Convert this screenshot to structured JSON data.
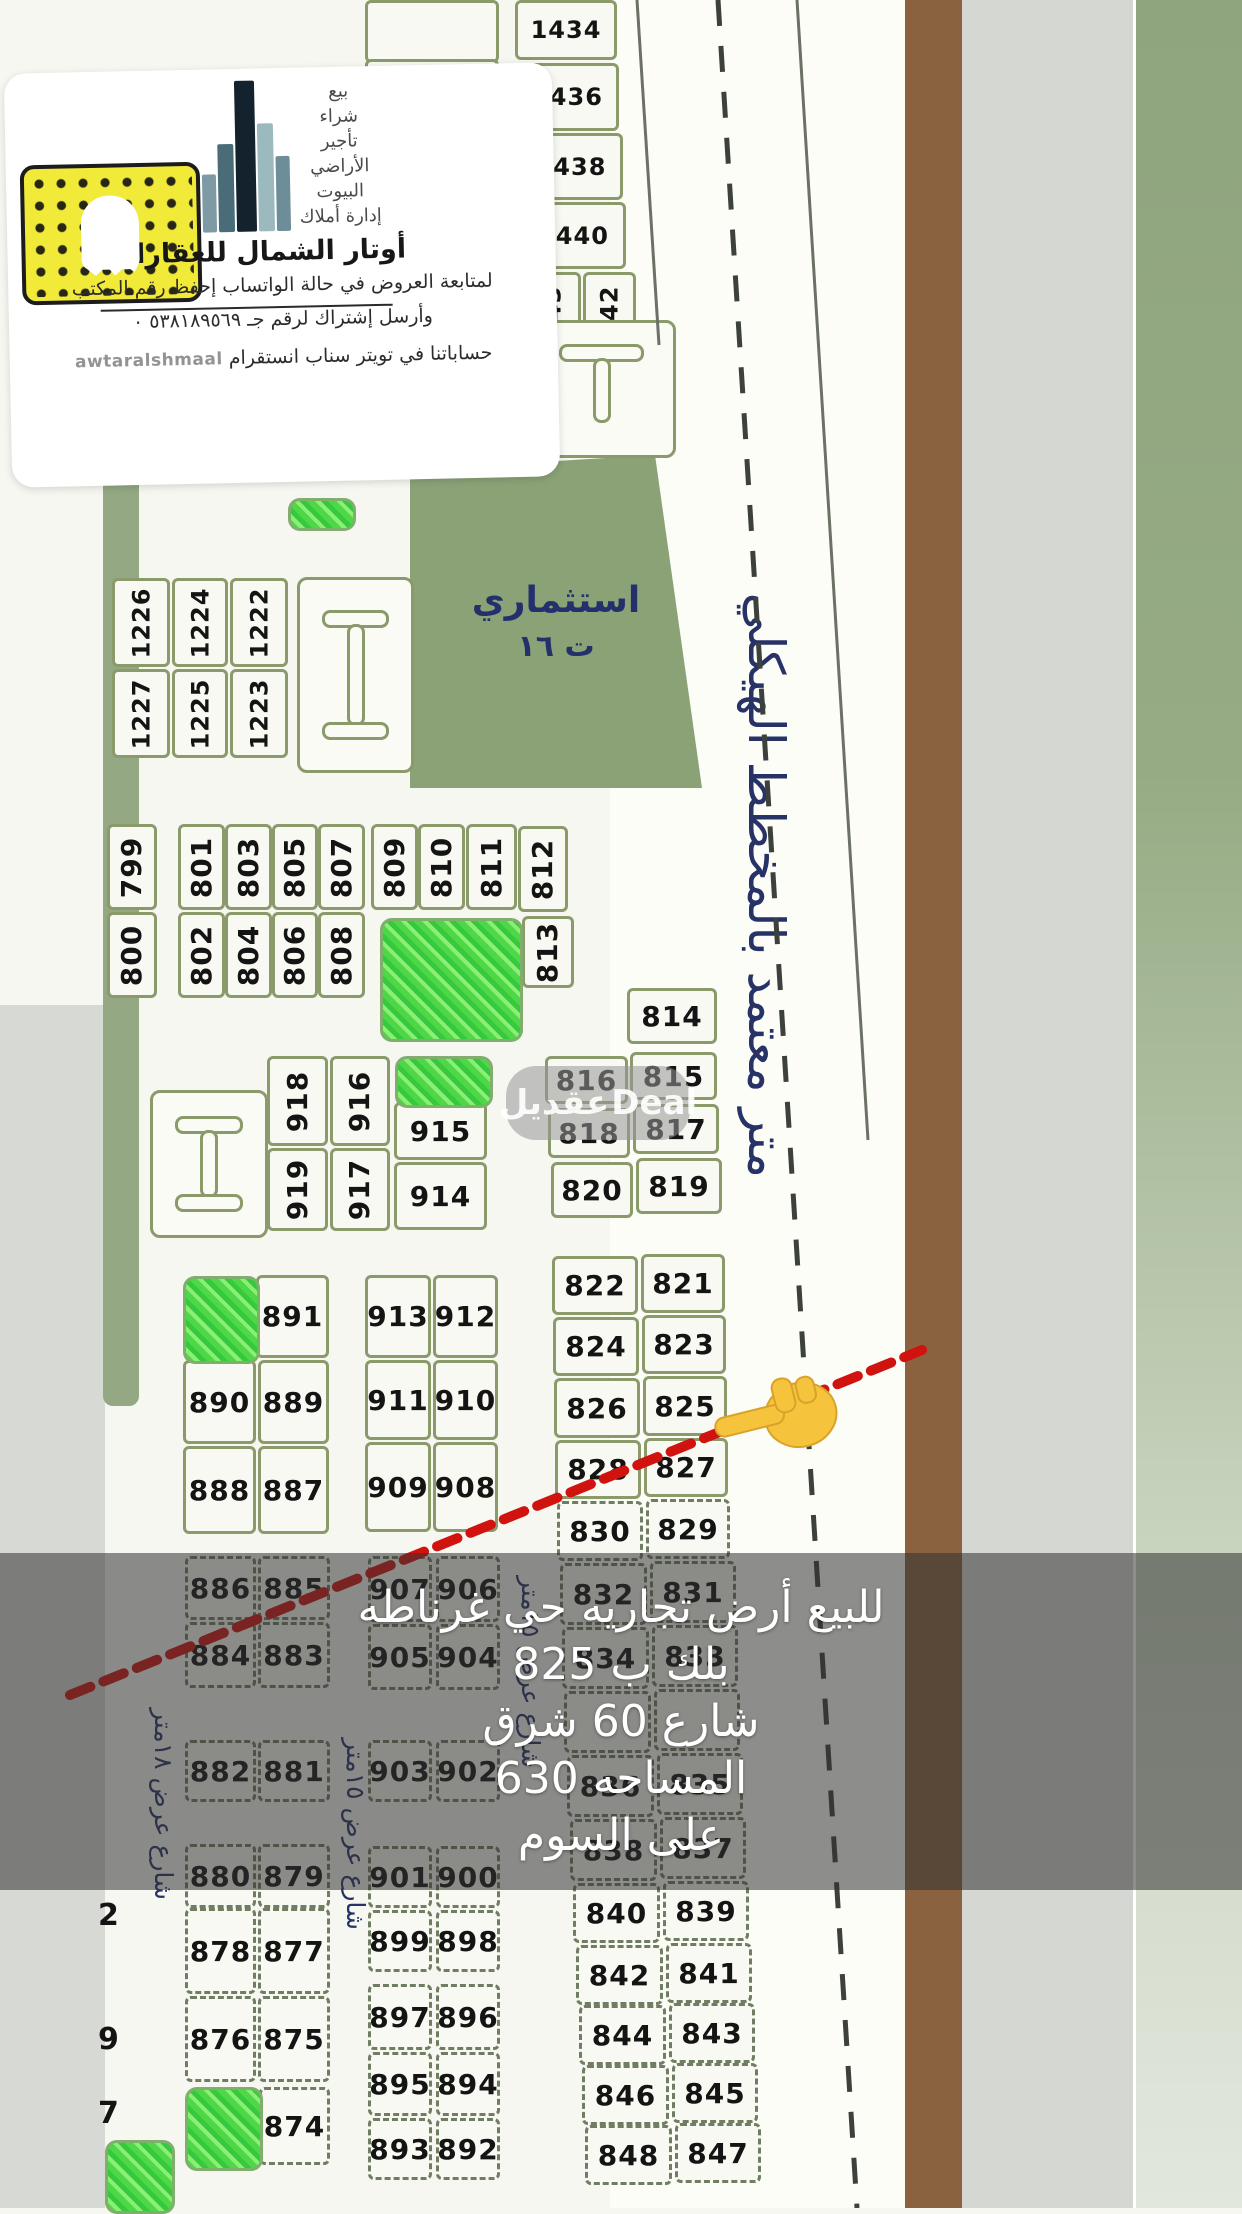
{
  "logo_card": {
    "services": [
      "بيع",
      "شراء",
      "تأجير",
      "الأراضي",
      "البيوت",
      "إدارة أملاك"
    ],
    "company_name": "أوتار الشمال للعقارات",
    "line1": "لمتابعة العروض في حالة الواتساب إحفظ رقم المكتب",
    "line2": "وأرسل إشتراك لرقم جـ ٥٣٨١٨٩٥٦٩ ٠",
    "line3": "حساباتنا في تويتر سناب انستقرام",
    "handle": "awtaralshmaal"
  },
  "overlay": {
    "lines": [
      "للبيع أرض  تجاريه حي غرناطه",
      "بلك ب 825",
      "شارع 60 شرق",
      "المساحه 630",
      "على السوم"
    ]
  },
  "map": {
    "road_label": "متر معتمد بالمخطط الهيكلي",
    "investment_label": "استثماري",
    "investment_sub": "ت ١٦",
    "watermark_ar": "عقديل",
    "watermark_en": "Deal",
    "colors": {
      "snap_yellow": "#f2ea39",
      "red_line": "#d11310",
      "brown_strip": "#8a6240",
      "sage": "#93a883",
      "park_green": "#4ed847"
    },
    "street_labels": [
      {
        "t": "شارع عرض ١٨متر",
        "x": 178,
        "y": 1600,
        "w": 300
      },
      {
        "t": "شارع عرض ١٥متر",
        "x": 370,
        "y": 1600,
        "w": 330
      },
      {
        "t": "شارع عرض ١٥متر",
        "x": 545,
        "y": 1478,
        "w": 290
      }
    ],
    "partial_digits": [
      {
        "t": "2",
        "x": 98,
        "y": 1898
      },
      {
        "t": "9",
        "x": 98,
        "y": 2022
      },
      {
        "t": "7",
        "x": 98,
        "y": 2096
      }
    ],
    "parks": [
      {
        "x": 288,
        "y": 498,
        "w": 62,
        "h": 27
      },
      {
        "x": 380,
        "y": 918,
        "w": 137,
        "h": 118
      },
      {
        "x": 395,
        "y": 1056,
        "w": 92,
        "h": 46
      },
      {
        "x": 183,
        "y": 1276,
        "w": 71,
        "h": 82
      },
      {
        "x": 185,
        "y": 2087,
        "w": 72,
        "h": 78
      },
      {
        "x": 105,
        "y": 2140,
        "w": 64,
        "h": 68
      }
    ],
    "iblocks": [
      {
        "type": "i",
        "x": 297,
        "y": 577,
        "w": 111,
        "h": 190
      },
      {
        "type": "i",
        "x": 150,
        "y": 1090,
        "w": 112,
        "h": 142
      },
      {
        "type": "t",
        "x": 527,
        "y": 320,
        "w": 143,
        "h": 132
      }
    ],
    "plots": [
      {
        "n": "1434",
        "x": 515,
        "y": 0,
        "w": 102,
        "h": 60,
        "s": 1
      },
      {
        "n": "1436",
        "x": 516,
        "y": 63,
        "w": 103,
        "h": 68,
        "s": 1
      },
      {
        "n": "1438",
        "x": 519,
        "y": 133,
        "w": 104,
        "h": 67,
        "s": 1
      },
      {
        "n": "1440",
        "x": 521,
        "y": 202,
        "w": 105,
        "h": 67,
        "s": 1
      },
      {
        "n": "1443",
        "x": 524,
        "y": 272,
        "w": 57,
        "h": 97,
        "r": 1,
        "s": 1
      },
      {
        "n": "1442",
        "x": 583,
        "y": 272,
        "w": 53,
        "h": 97,
        "r": 1,
        "s": 1
      },
      {
        "n": "1226",
        "x": 112,
        "y": 578,
        "w": 58,
        "h": 89,
        "r": 1,
        "s": 1
      },
      {
        "n": "1227",
        "x": 112,
        "y": 669,
        "w": 58,
        "h": 89,
        "r": 1,
        "s": 1
      },
      {
        "n": "1224",
        "x": 172,
        "y": 578,
        "w": 56,
        "h": 89,
        "r": 1,
        "s": 1
      },
      {
        "n": "1225",
        "x": 172,
        "y": 669,
        "w": 56,
        "h": 89,
        "r": 1,
        "s": 1
      },
      {
        "n": "1222",
        "x": 230,
        "y": 578,
        "w": 58,
        "h": 89,
        "r": 1,
        "s": 1
      },
      {
        "n": "1223",
        "x": 230,
        "y": 669,
        "w": 58,
        "h": 89,
        "r": 1,
        "s": 1
      },
      {
        "n": "799",
        "x": 107,
        "y": 824,
        "w": 50,
        "h": 86,
        "r": 1
      },
      {
        "n": "800",
        "x": 107,
        "y": 912,
        "w": 50,
        "h": 86,
        "r": 1
      },
      {
        "n": "801",
        "x": 178,
        "y": 824,
        "w": 47,
        "h": 86,
        "r": 1
      },
      {
        "n": "802",
        "x": 178,
        "y": 912,
        "w": 47,
        "h": 86,
        "r": 1
      },
      {
        "n": "803",
        "x": 225,
        "y": 824,
        "w": 47,
        "h": 86,
        "r": 1
      },
      {
        "n": "804",
        "x": 225,
        "y": 912,
        "w": 47,
        "h": 86,
        "r": 1
      },
      {
        "n": "805",
        "x": 272,
        "y": 824,
        "w": 46,
        "h": 86,
        "r": 1
      },
      {
        "n": "806",
        "x": 272,
        "y": 912,
        "w": 46,
        "h": 86,
        "r": 1
      },
      {
        "n": "807",
        "x": 318,
        "y": 824,
        "w": 47,
        "h": 86,
        "r": 1
      },
      {
        "n": "808",
        "x": 318,
        "y": 912,
        "w": 47,
        "h": 86,
        "r": 1
      },
      {
        "n": "809",
        "x": 371,
        "y": 824,
        "w": 47,
        "h": 86,
        "r": 1
      },
      {
        "n": "810",
        "x": 418,
        "y": 824,
        "w": 47,
        "h": 86,
        "r": 1
      },
      {
        "n": "811",
        "x": 466,
        "y": 824,
        "w": 51,
        "h": 86,
        "r": 1
      },
      {
        "n": "812",
        "x": 518,
        "y": 826,
        "w": 50,
        "h": 86,
        "r": 1
      },
      {
        "n": "813",
        "x": 522,
        "y": 916,
        "w": 52,
        "h": 72,
        "r": 1
      },
      {
        "n": "814",
        "x": 627,
        "y": 988,
        "w": 90,
        "h": 56
      },
      {
        "n": "816",
        "x": 545,
        "y": 1056,
        "w": 83,
        "h": 48
      },
      {
        "n": "815",
        "x": 630,
        "y": 1052,
        "w": 87,
        "h": 48
      },
      {
        "n": "818",
        "x": 548,
        "y": 1108,
        "w": 82,
        "h": 50
      },
      {
        "n": "817",
        "x": 633,
        "y": 1104,
        "w": 86,
        "h": 50
      },
      {
        "n": "820",
        "x": 551,
        "y": 1162,
        "w": 82,
        "h": 56
      },
      {
        "n": "819",
        "x": 636,
        "y": 1158,
        "w": 86,
        "h": 56
      },
      {
        "n": "822",
        "x": 552,
        "y": 1256,
        "w": 86,
        "h": 59
      },
      {
        "n": "821",
        "x": 641,
        "y": 1254,
        "w": 84,
        "h": 59
      },
      {
        "n": "824",
        "x": 553,
        "y": 1317,
        "w": 86,
        "h": 59
      },
      {
        "n": "823",
        "x": 642,
        "y": 1315,
        "w": 84,
        "h": 59
      },
      {
        "n": "826",
        "x": 554,
        "y": 1378,
        "w": 86,
        "h": 60
      },
      {
        "n": "825",
        "x": 643,
        "y": 1376,
        "w": 84,
        "h": 60
      },
      {
        "n": "828",
        "x": 555,
        "y": 1440,
        "w": 86,
        "h": 59
      },
      {
        "n": "827",
        "x": 644,
        "y": 1438,
        "w": 84,
        "h": 59
      },
      {
        "n": "830",
        "x": 557,
        "y": 1501,
        "w": 86,
        "h": 60,
        "d": 1
      },
      {
        "n": "829",
        "x": 646,
        "y": 1499,
        "w": 84,
        "h": 60,
        "d": 1
      },
      {
        "n": "832",
        "x": 560,
        "y": 1563,
        "w": 87,
        "h": 62,
        "d": 1
      },
      {
        "n": "831",
        "x": 650,
        "y": 1561,
        "w": 86,
        "h": 62,
        "d": 1
      },
      {
        "n": "834",
        "x": 562,
        "y": 1627,
        "w": 87,
        "h": 62,
        "d": 1
      },
      {
        "n": "833",
        "x": 652,
        "y": 1625,
        "w": 86,
        "h": 62,
        "d": 1
      },
      {
        "n": null,
        "x": 564,
        "y": 1691,
        "w": 87,
        "h": 62,
        "d": 1
      },
      {
        "n": null,
        "x": 654,
        "y": 1689,
        "w": 86,
        "h": 62,
        "d": 1
      },
      {
        "n": "836",
        "x": 567,
        "y": 1755,
        "w": 87,
        "h": 62,
        "d": 1
      },
      {
        "n": "835",
        "x": 657,
        "y": 1753,
        "w": 86,
        "h": 62,
        "d": 1
      },
      {
        "n": "838",
        "x": 570,
        "y": 1819,
        "w": 87,
        "h": 62,
        "d": 1
      },
      {
        "n": "837",
        "x": 660,
        "y": 1817,
        "w": 86,
        "h": 62,
        "d": 1
      },
      {
        "n": "840",
        "x": 573,
        "y": 1883,
        "w": 87,
        "h": 60,
        "d": 1
      },
      {
        "n": "839",
        "x": 663,
        "y": 1881,
        "w": 86,
        "h": 60,
        "d": 1
      },
      {
        "n": "842",
        "x": 576,
        "y": 1945,
        "w": 87,
        "h": 60,
        "d": 1
      },
      {
        "n": "841",
        "x": 666,
        "y": 1943,
        "w": 86,
        "h": 60,
        "d": 1
      },
      {
        "n": "844",
        "x": 579,
        "y": 2005,
        "w": 87,
        "h": 60,
        "d": 1
      },
      {
        "n": "843",
        "x": 669,
        "y": 2003,
        "w": 86,
        "h": 60,
        "d": 1
      },
      {
        "n": "846",
        "x": 582,
        "y": 2065,
        "w": 87,
        "h": 60,
        "d": 1
      },
      {
        "n": "845",
        "x": 672,
        "y": 2063,
        "w": 86,
        "h": 60,
        "d": 1
      },
      {
        "n": "848",
        "x": 585,
        "y": 2125,
        "w": 87,
        "h": 60,
        "d": 1
      },
      {
        "n": "847",
        "x": 675,
        "y": 2123,
        "w": 86,
        "h": 60,
        "d": 1
      },
      {
        "n": "918",
        "x": 267,
        "y": 1056,
        "w": 61,
        "h": 90,
        "r": 1
      },
      {
        "n": "916",
        "x": 330,
        "y": 1056,
        "w": 60,
        "h": 90,
        "r": 1
      },
      {
        "n": "919",
        "x": 267,
        "y": 1148,
        "w": 61,
        "h": 83,
        "r": 1
      },
      {
        "n": "917",
        "x": 330,
        "y": 1148,
        "w": 60,
        "h": 83,
        "r": 1
      },
      {
        "n": "915",
        "x": 394,
        "y": 1102,
        "w": 93,
        "h": 58
      },
      {
        "n": "914",
        "x": 394,
        "y": 1162,
        "w": 93,
        "h": 68
      },
      {
        "n": "891",
        "x": 256,
        "y": 1275,
        "w": 73,
        "h": 83
      },
      {
        "n": "890",
        "x": 183,
        "y": 1360,
        "w": 73,
        "h": 84
      },
      {
        "n": "889",
        "x": 258,
        "y": 1360,
        "w": 71,
        "h": 84
      },
      {
        "n": "888",
        "x": 183,
        "y": 1446,
        "w": 73,
        "h": 88
      },
      {
        "n": "887",
        "x": 258,
        "y": 1446,
        "w": 71,
        "h": 88
      },
      {
        "n": "913",
        "x": 365,
        "y": 1275,
        "w": 66,
        "h": 83
      },
      {
        "n": "912",
        "x": 433,
        "y": 1275,
        "w": 65,
        "h": 83
      },
      {
        "n": "911",
        "x": 365,
        "y": 1360,
        "w": 66,
        "h": 80
      },
      {
        "n": "910",
        "x": 433,
        "y": 1360,
        "w": 65,
        "h": 80
      },
      {
        "n": "909",
        "x": 365,
        "y": 1442,
        "w": 66,
        "h": 90
      },
      {
        "n": "908",
        "x": 433,
        "y": 1442,
        "w": 65,
        "h": 90
      },
      {
        "n": "886",
        "x": 185,
        "y": 1556,
        "w": 71,
        "h": 64,
        "d": 1
      },
      {
        "n": "885",
        "x": 258,
        "y": 1556,
        "w": 72,
        "h": 64,
        "d": 1
      },
      {
        "n": "884",
        "x": 185,
        "y": 1622,
        "w": 71,
        "h": 66,
        "d": 1
      },
      {
        "n": "883",
        "x": 258,
        "y": 1622,
        "w": 72,
        "h": 66,
        "d": 1
      },
      {
        "n": "882",
        "x": 185,
        "y": 1740,
        "w": 71,
        "h": 62,
        "d": 1
      },
      {
        "n": "881",
        "x": 258,
        "y": 1740,
        "w": 72,
        "h": 62,
        "d": 1
      },
      {
        "n": "880",
        "x": 185,
        "y": 1844,
        "w": 71,
        "h": 64,
        "d": 1
      },
      {
        "n": "879",
        "x": 258,
        "y": 1844,
        "w": 72,
        "h": 64,
        "d": 1
      },
      {
        "n": "878",
        "x": 185,
        "y": 1908,
        "w": 71,
        "h": 86,
        "d": 1
      },
      {
        "n": "877",
        "x": 258,
        "y": 1908,
        "w": 72,
        "h": 86,
        "d": 1
      },
      {
        "n": "876",
        "x": 185,
        "y": 1996,
        "w": 71,
        "h": 86,
        "d": 1
      },
      {
        "n": "875",
        "x": 258,
        "y": 1996,
        "w": 72,
        "h": 86,
        "d": 1
      },
      {
        "n": "874",
        "x": 259,
        "y": 2087,
        "w": 71,
        "h": 78,
        "d": 1
      },
      {
        "n": "907",
        "x": 368,
        "y": 1556,
        "w": 64,
        "h": 66,
        "d": 1
      },
      {
        "n": "906",
        "x": 436,
        "y": 1556,
        "w": 64,
        "h": 66,
        "d": 1
      },
      {
        "n": "905",
        "x": 368,
        "y": 1624,
        "w": 64,
        "h": 66,
        "d": 1
      },
      {
        "n": "904",
        "x": 436,
        "y": 1624,
        "w": 64,
        "h": 66,
        "d": 1
      },
      {
        "n": "903",
        "x": 368,
        "y": 1740,
        "w": 64,
        "h": 62,
        "d": 1
      },
      {
        "n": "902",
        "x": 436,
        "y": 1740,
        "w": 64,
        "h": 62,
        "d": 1
      },
      {
        "n": "901",
        "x": 368,
        "y": 1846,
        "w": 64,
        "h": 62,
        "d": 1
      },
      {
        "n": "900",
        "x": 436,
        "y": 1846,
        "w": 64,
        "h": 62,
        "d": 1
      },
      {
        "n": "899",
        "x": 368,
        "y": 1910,
        "w": 64,
        "h": 62,
        "d": 1
      },
      {
        "n": "898",
        "x": 436,
        "y": 1910,
        "w": 64,
        "h": 62,
        "d": 1
      },
      {
        "n": "897",
        "x": 368,
        "y": 1984,
        "w": 64,
        "h": 66,
        "d": 1
      },
      {
        "n": "896",
        "x": 436,
        "y": 1984,
        "w": 64,
        "h": 66,
        "d": 1
      },
      {
        "n": "895",
        "x": 368,
        "y": 2052,
        "w": 64,
        "h": 64,
        "d": 1
      },
      {
        "n": "894",
        "x": 436,
        "y": 2052,
        "w": 64,
        "h": 64,
        "d": 1
      },
      {
        "n": "893",
        "x": 368,
        "y": 2118,
        "w": 64,
        "h": 62,
        "d": 1
      },
      {
        "n": "892",
        "x": 436,
        "y": 2118,
        "w": 64,
        "h": 62,
        "d": 1
      }
    ]
  }
}
